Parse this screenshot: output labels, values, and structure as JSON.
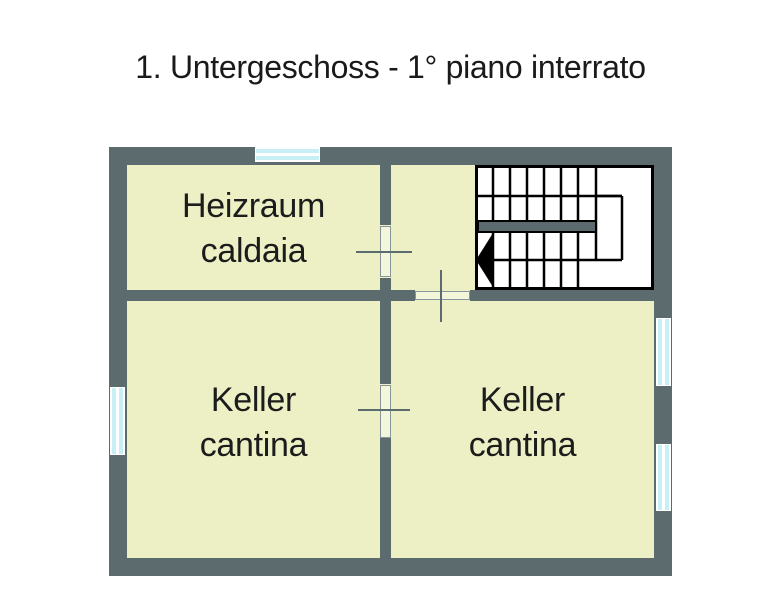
{
  "title": "1. Untergeschoss - 1° piano interrato",
  "floor_plan": {
    "rooms": [
      {
        "name_de": "Heizraum",
        "name_it": "caldaia"
      },
      {
        "name_de": "Keller",
        "name_it": "cantina"
      },
      {
        "name_de": "Keller",
        "name_it": "cantina"
      }
    ],
    "staircase": "u-shaped-stair-with-down-arrow",
    "window_count": 4,
    "door_count": 3,
    "colors": {
      "wall": "#5c6b6e",
      "room_fill": "#edefc5",
      "window_glass": "#c7eff5",
      "door_leaf": "#f4f6dc",
      "stair_lines": "#000000",
      "title_text": "#1a1a1a",
      "background": "#ffffff"
    }
  }
}
